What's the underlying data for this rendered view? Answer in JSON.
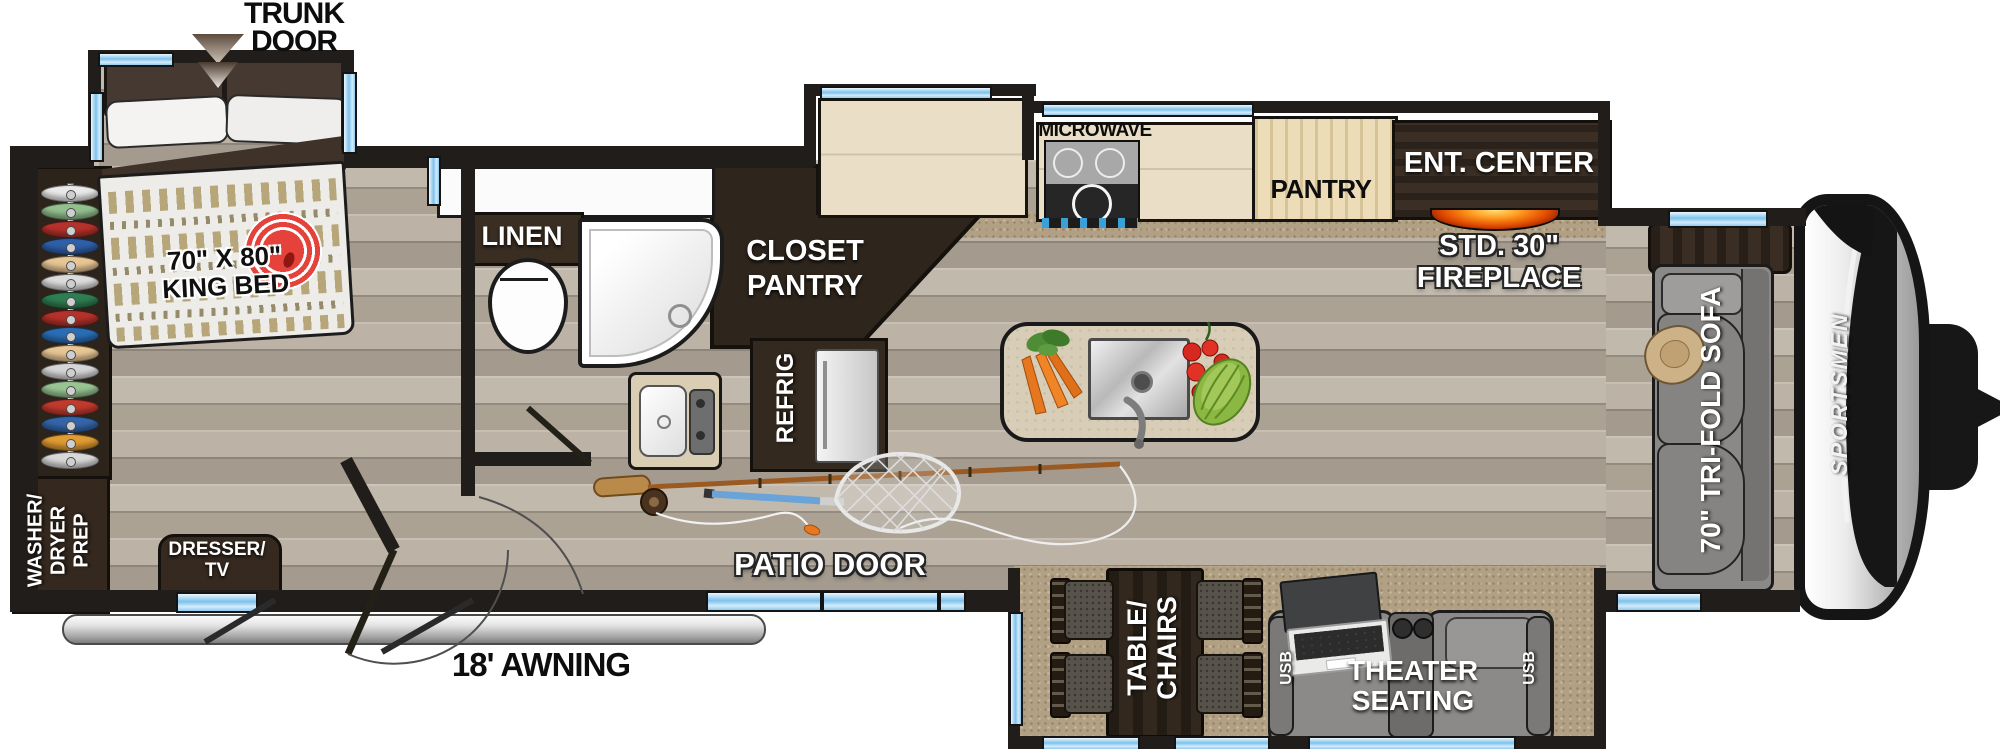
{
  "floorplan": {
    "brand": "SPORTSMEN",
    "exterior": {
      "trunk_door_line1": "TRUNK",
      "trunk_door_line2": "DOOR",
      "awning": "18' AWNING",
      "patio_door": "PATIO DOOR"
    },
    "bedroom": {
      "bed_line1": "70\" X 80\"",
      "bed_line2": "KING BED",
      "washer_line1": "WASHER/",
      "washer_line2": "DRYER",
      "washer_line3": "PREP",
      "dresser_line1": "DRESSER/",
      "dresser_line2": "TV",
      "hanger_colors": [
        "#e9e9e9",
        "#93bf8e",
        "#b5312b",
        "#2f5fa8",
        "#e7c694",
        "#dcdcdc",
        "#2f7d52",
        "#b5312b",
        "#2a6db5",
        "#e7c694",
        "#d6d6d6",
        "#98c492",
        "#c03a2d",
        "#3465a8",
        "#e09b33",
        "#d9d9d9"
      ]
    },
    "bathroom": {
      "linen": "LINEN",
      "closet_line1": "CLOSET",
      "closet_line2": "PANTRY",
      "refrig": "REFRIG"
    },
    "kitchen": {
      "microwave": "MICROWAVE",
      "pantry": "PANTRY",
      "ent_center": "ENT. CENTER",
      "fireplace_line1": "STD. 30\"",
      "fireplace_line2": "FIREPLACE"
    },
    "living": {
      "sofa": "70\" TRI-FOLD SOFA",
      "theater_line1": "THEATER",
      "theater_line2": "SEATING",
      "usb_left": "USB",
      "usb_right": "USB",
      "table_line1": "TABLE/",
      "table_line2": "CHAIRS"
    },
    "colors": {
      "wall": "#201d1a",
      "window_blue": "#7ec1ec",
      "accent_red": "#e4423a",
      "fire_orange": "#ff8a00",
      "wood_floor": "#b5ac9f",
      "carpet": "#b1a084"
    }
  }
}
